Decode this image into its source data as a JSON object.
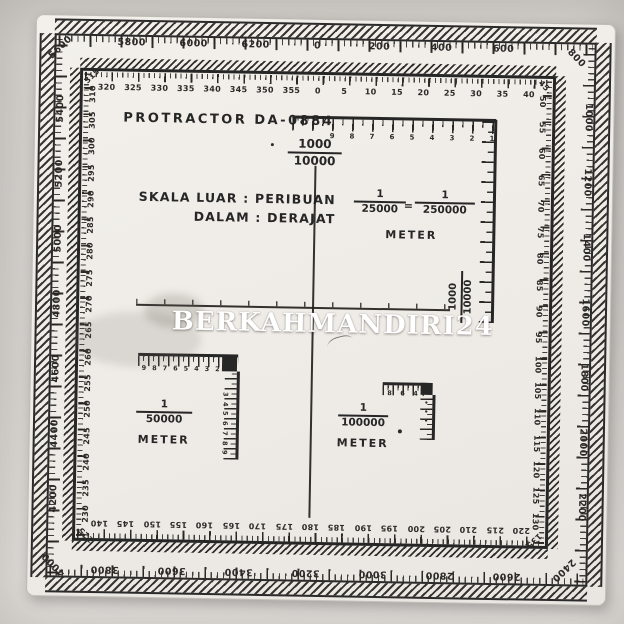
{
  "photo": {
    "background": "#d6d3cf",
    "sheet_color": "#f1eee9",
    "ink": "#262626"
  },
  "watermark": {
    "text": "BERKAHMANDIRI24",
    "color": "#ffffff"
  },
  "title": "PROTRACTOR DA-0884",
  "legend": {
    "line1": "SKALA LUAR : PERIBUAN",
    "line2": "DALAM : DERAJAT"
  },
  "scale_1000": {
    "numerator": "1000",
    "denominator": "10000"
  },
  "scale_1000_side": {
    "numerator": "1000",
    "denominator": "10000"
  },
  "scale_25000": {
    "f1_num": "1",
    "f1_den": "25000",
    "equals": "=",
    "f2_num": "1",
    "f2_den": "250000",
    "unit": "METER",
    "ruler_digits": [
      "9",
      "8",
      "7",
      "6",
      "5",
      "4",
      "3",
      "2",
      "1"
    ]
  },
  "scale_50000": {
    "num": "1",
    "den": "50000",
    "unit": "METER",
    "h_digits": [
      "9",
      "8",
      "7",
      "6",
      "5",
      "4",
      "3",
      "2"
    ],
    "v_digits": [
      "3",
      "4",
      "5",
      "6",
      "7",
      "8",
      "9"
    ]
  },
  "scale_100000": {
    "num": "1",
    "den": "100000",
    "unit": "METER",
    "h_digits": [
      "8",
      "6",
      "4"
    ],
    "v_marks": [
      "•",
      "•",
      "•"
    ]
  },
  "outer_scale": {
    "name": "peribuan (mils)",
    "top": [
      "5800",
      "6000",
      "6200",
      "0",
      "200",
      "400",
      "600"
    ],
    "right": [
      "1000",
      "1200",
      "1400",
      "1600",
      "1800",
      "2000",
      "2200"
    ],
    "bottom": [
      "3800",
      "3600",
      "3400",
      "3200",
      "3000",
      "2800",
      "2600"
    ],
    "left": [
      "5400",
      "5200",
      "5000",
      "4800",
      "4600",
      "4400",
      "4200"
    ],
    "corners": {
      "top_left": "5600",
      "top_right": "800",
      "bottom_right": "2400",
      "bottom_left": "4000"
    }
  },
  "inner_scale": {
    "name": "derajat (degrees)",
    "top": [
      "320",
      "325",
      "330",
      "335",
      "340",
      "345",
      "350",
      "355",
      "0",
      "5",
      "10",
      "15",
      "20",
      "25",
      "30",
      "35",
      "40"
    ],
    "right": [
      "50",
      "55",
      "60",
      "65",
      "70",
      "75",
      "80",
      "85",
      "90",
      "95",
      "100",
      "105",
      "110",
      "115",
      "120",
      "125",
      "130"
    ],
    "bottom": [
      "220",
      "215",
      "210",
      "205",
      "200",
      "195",
      "190",
      "185",
      "180",
      "175",
      "170",
      "165",
      "160",
      "155",
      "150",
      "145",
      "140"
    ],
    "left": [
      "310",
      "305",
      "300",
      "295",
      "290",
      "285",
      "280",
      "275",
      "270",
      "265",
      "260",
      "255",
      "250",
      "245",
      "240",
      "235",
      "230"
    ],
    "corners": {
      "top_left": "315",
      "top_right": "45",
      "bottom_right": "135",
      "bottom_left": "225"
    }
  }
}
